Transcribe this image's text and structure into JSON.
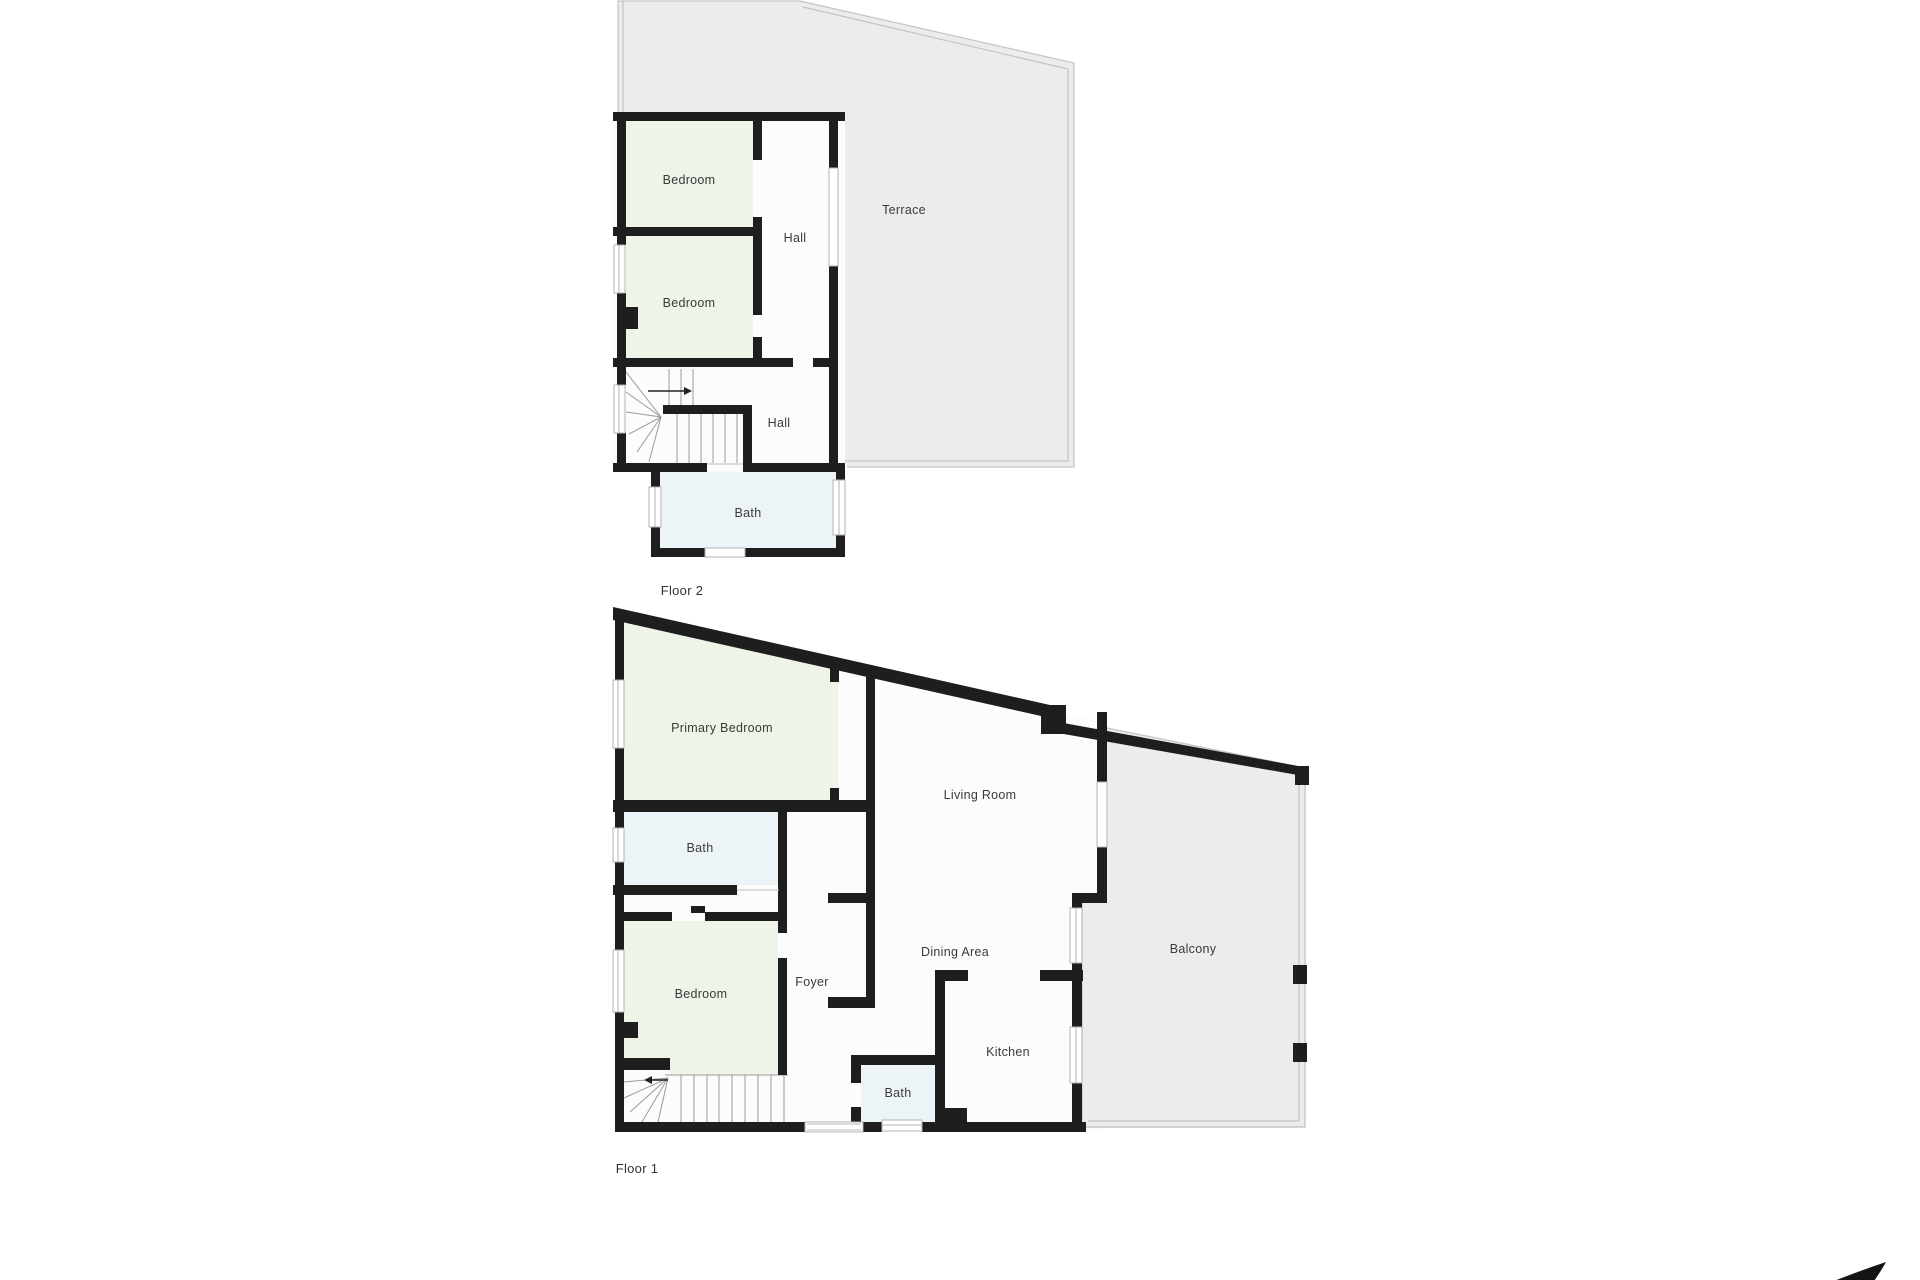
{
  "floor2": {
    "name": "Floor 2",
    "rooms": {
      "bedroom_top": "Bedroom",
      "bedroom_bottom": "Bedroom",
      "hall_upper": "Hall",
      "hall_lower": "Hall",
      "bath": "Bath",
      "terrace": "Terrace"
    }
  },
  "floor1": {
    "name": "Floor 1",
    "rooms": {
      "primary_bedroom": "Primary Bedroom",
      "bath_main": "Bath",
      "bedroom": "Bedroom",
      "foyer": "Foyer",
      "living_room": "Living Room",
      "dining_area": "Dining Area",
      "kitchen": "Kitchen",
      "bath_small": "Bath",
      "balcony": "Balcony"
    }
  },
  "icons": {
    "north_arrow": "north-arrow"
  },
  "colors": {
    "wall": "#1e1e1e",
    "bedroom_fill": "#eff4e9",
    "bath_fill": "#edf4f8",
    "interior_fill": "#fcfcfc",
    "outdoor_fill": "#ececec",
    "outdoor_line": "#c4c4c4",
    "stair_line": "#9a9a9a",
    "label_text": "#3a3a3a"
  }
}
